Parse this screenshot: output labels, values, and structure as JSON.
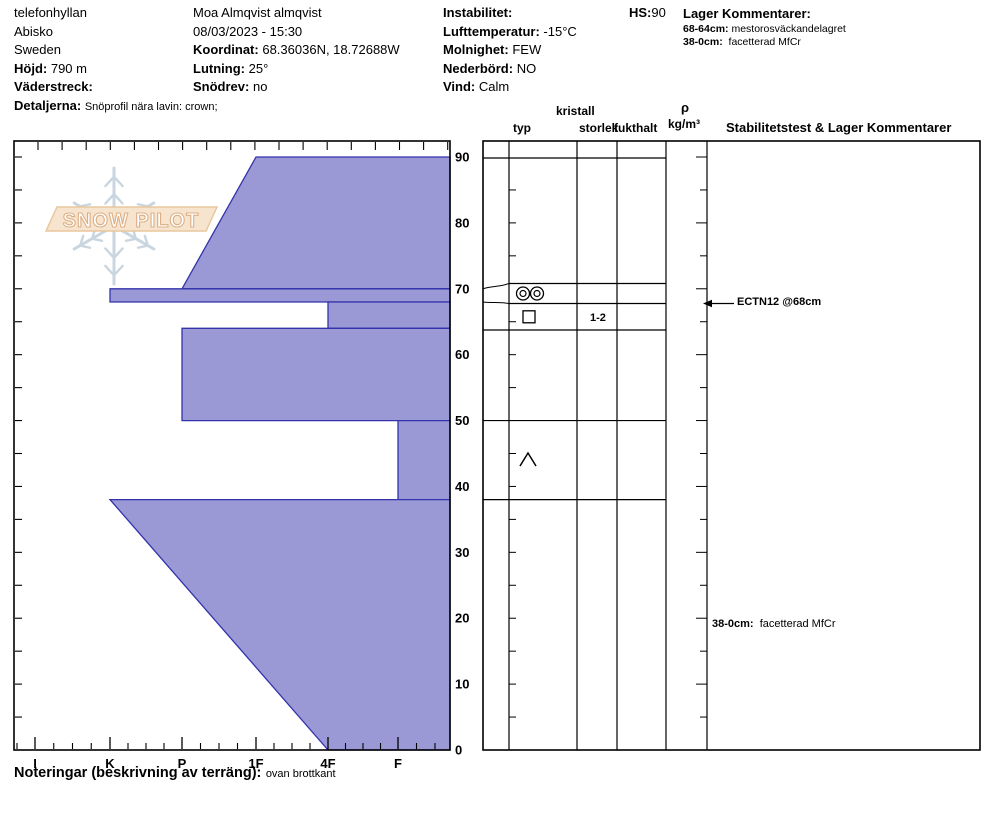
{
  "header": {
    "col1": {
      "site": "telefonhyllan",
      "area": "Abisko",
      "country": "Sweden",
      "hojd_label": "Höjd:",
      "hojd": "790 m",
      "vaderstreck_label": "Väderstreck:",
      "vaderstreck": "",
      "detaljerna_label": "Detaljerna:",
      "detaljerna": "Snöprofil nära lavin: crown;"
    },
    "col2": {
      "observer": "Moa Almqvist almqvist",
      "datetime": "08/03/2023 - 15:30",
      "koordinat_label": "Koordinat:",
      "koordinat": "68.36036N, 18.72688W",
      "lutning_label": "Lutning:",
      "lutning": "25°",
      "snodrev_label": "Snödrev:",
      "snodrev": "no"
    },
    "col3": {
      "instabilitet_label": "Instabilitet:",
      "instabilitet": "",
      "lufttemperatur_label": "Lufttemperatur:",
      "lufttemperatur": "-15°C",
      "molnighet_label": "Molnighet:",
      "molnighet": "FEW",
      "nederbord_label": "Nederbörd:",
      "nederbord": "NO",
      "vind_label": "Vind:",
      "vind": "Calm"
    },
    "hs_label": "HS:",
    "hs": "90",
    "lager": {
      "title": "Lager Kommentarer:",
      "items": [
        {
          "range": "68-64cm:",
          "text": "mestorosväckandelagret"
        },
        {
          "range": "38-0cm:",
          "text": "facetterad MfCr"
        }
      ]
    }
  },
  "logo": {
    "text": "SNOW PILOT"
  },
  "chart_data": {
    "type": "area",
    "title": "Snow profile: hand hardness vs depth (cm)",
    "depth_axis": {
      "unit": "cm",
      "min": 0,
      "max": 90,
      "major_ticks": [
        90,
        80,
        70,
        60,
        50,
        40,
        30,
        20,
        10,
        0
      ],
      "minor_step": 5,
      "side": "right"
    },
    "hardness_axis": {
      "categories": [
        "I",
        "K",
        "P",
        "1F",
        "4F",
        "F"
      ],
      "side": "bottom",
      "note": "hardness increases to the left"
    },
    "total_depth_cm": 90,
    "layers": [
      {
        "top_cm": 90,
        "bottom_cm": 70,
        "hardness_top": "1F",
        "hardness_bottom": "P"
      },
      {
        "top_cm": 70,
        "bottom_cm": 68,
        "hardness_top": "K",
        "hardness_bottom": "K"
      },
      {
        "top_cm": 68,
        "bottom_cm": 64,
        "hardness_top": "4F",
        "hardness_bottom": "4F"
      },
      {
        "top_cm": 64,
        "bottom_cm": 50,
        "hardness_top": "P",
        "hardness_bottom": "P"
      },
      {
        "top_cm": 50,
        "bottom_cm": 38,
        "hardness_top": "F",
        "hardness_bottom": "F"
      },
      {
        "top_cm": 38,
        "bottom_cm": 0,
        "hardness_top": "K",
        "hardness_bottom": "4F"
      }
    ],
    "colors": {
      "fill": "#9a99d6",
      "stroke": "#3333aa"
    },
    "grid": false,
    "legend": false
  },
  "table": {
    "columns": {
      "kristall": "kristall",
      "typ": "typ",
      "storlek": "storlek",
      "fukthalt": "fukthalt",
      "rho": "ρ",
      "rho_unit": "kg/m³",
      "stab": "Stabilitetstest & Lager Kommentarer"
    },
    "rows": [
      {
        "layer_range": "70-68cm",
        "grain_symbol": "double-circle",
        "grain_size": "",
        "moisture": "",
        "density": ""
      },
      {
        "layer_range": "68-64cm",
        "grain_symbol": "square",
        "grain_size": "1-2",
        "moisture": "",
        "density": ""
      },
      {
        "layer_range": "50-38cm",
        "grain_symbol": "chevron-up",
        "grain_size": "",
        "moisture": "",
        "density": ""
      }
    ],
    "stability_annotation": {
      "text": "ECTN12 @68cm",
      "depth_cm": 68
    },
    "layer_comment": {
      "range": "38-0cm:",
      "text": "facetterad MfCr"
    }
  },
  "footer": {
    "label": "Noteringar (beskrivning av terräng):",
    "text": "ovan brottkant"
  }
}
